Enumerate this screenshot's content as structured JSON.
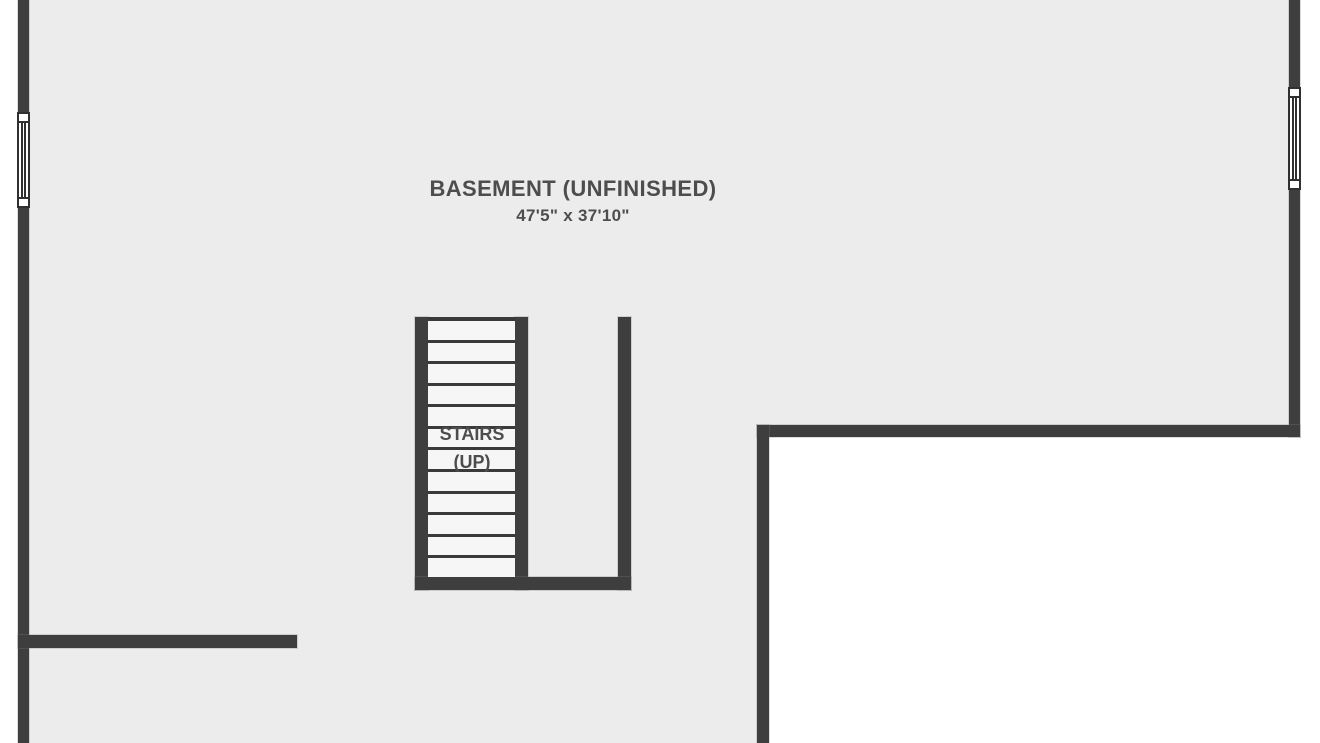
{
  "floorplan": {
    "room": {
      "label": "BASEMENT (UNFINISHED)",
      "dimensions": "47'5\" x 37'10\""
    },
    "stairs": {
      "label": "STAIRS",
      "direction": "(UP)",
      "tread_count": 12
    },
    "windows": [
      "left-wall-window",
      "right-wall-window"
    ]
  },
  "colors": {
    "wall": "#3e3e3e",
    "floor": "#ececec",
    "stair-floor": "#f6f6f6",
    "tread-line": "#3a3a3a",
    "label-text": "#4d4d4d",
    "outside": "#ffffff"
  }
}
